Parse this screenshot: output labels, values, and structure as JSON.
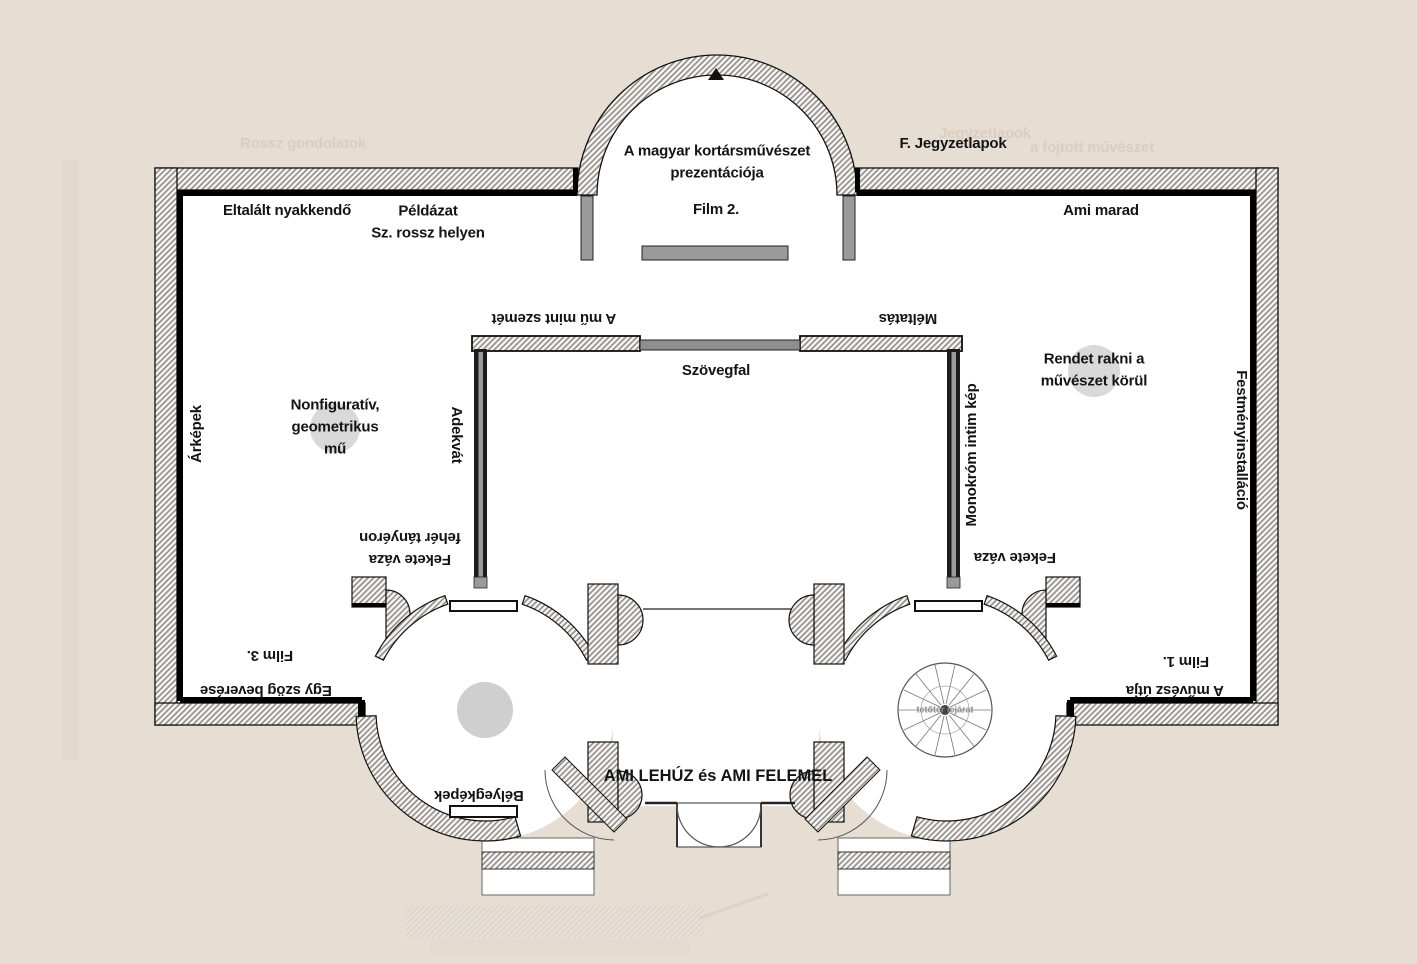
{
  "colors": {
    "background": "#e6ded3",
    "floor": "#ffffff",
    "wall_outline": "#111111",
    "wall_hatch": "#908d88",
    "gray_fixture": "#9a9a9a",
    "pedestal": "#d2d2d2",
    "ghost_text": "#d9cec0"
  },
  "labels": {
    "title": {
      "text": "A magyar kortársművészet\nprezentációja"
    },
    "film2": {
      "text": "Film 2."
    },
    "eltalalt": {
      "text": "Eltalált nyakkendő"
    },
    "peldazat": {
      "text": "Példázat\nSz. rossz helyen"
    },
    "fjegyzet": {
      "text": "F. Jegyzetlapok"
    },
    "amimarad": {
      "text": "Ami marad"
    },
    "amumint": {
      "text": "A mű mint szemét"
    },
    "meltatas": {
      "text": "Méltatás"
    },
    "szovegfal": {
      "text": "Szövegfal"
    },
    "rendet": {
      "text": "Rendet rakni a\nművészet körül"
    },
    "arkepek": {
      "text": "Árképek"
    },
    "nonfigurativ": {
      "text": "Nonfiguratív,\ngeometrikus\nmű"
    },
    "adekvat": {
      "text": "Adekvát"
    },
    "fekete_tanyer": {
      "text": "Fekete váza\nfehér tányéron"
    },
    "fekete": {
      "text": "Fekete váza"
    },
    "monokrom": {
      "text": "Monokróm intim kép"
    },
    "festmeny": {
      "text": "Festményinstalláció"
    },
    "film3": {
      "text": "Film 3."
    },
    "egyszog": {
      "text": "Egy szög beverése"
    },
    "film1": {
      "text": "Film 1."
    },
    "amuvesz": {
      "text": "A művész útja"
    },
    "belyeg": {
      "text": "Bélyegképek"
    },
    "amilehuz": {
      "text": "AMI LEHÚZ és AMI FELEMEL"
    },
    "tetoter": {
      "text": "tetőtér lejárat"
    },
    "ghost_rossz": {
      "text": "Rossz gondolatok"
    },
    "ghost_fojtott": {
      "text": "a fojtott művészet"
    },
    "ghost_jegyzet": {
      "text": "Jegyzetlapok"
    }
  }
}
